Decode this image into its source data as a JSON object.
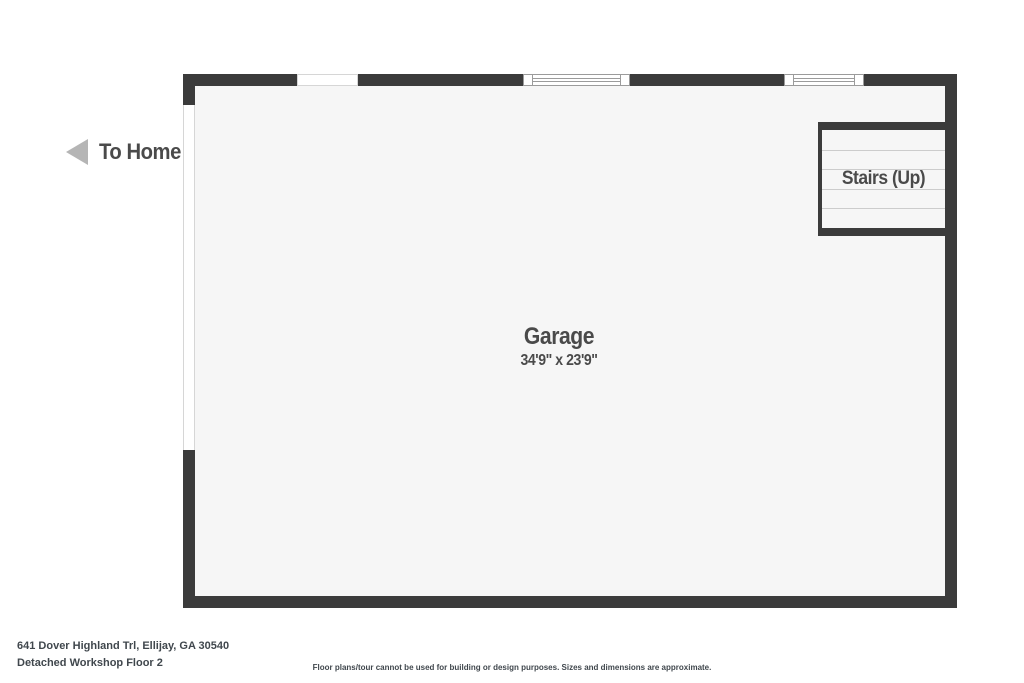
{
  "nav": {
    "to_home_label": "To Home"
  },
  "rooms": {
    "garage": {
      "name": "Garage",
      "dimensions": "34'9\" x 23'9\""
    },
    "stairs": {
      "label": "Stairs (Up)"
    }
  },
  "footer": {
    "address": "641 Dover Highland Trl, Ellijay, GA 30540",
    "floor_label": "Detached Workshop Floor 2",
    "disclaimer": "Floor plans/tour cannot be used for building or design purposes. Sizes and dimensions are approximate."
  },
  "colors": {
    "wall": "#3b3b3b",
    "interior": "#f6f6f6",
    "tread_line": "#cccccc",
    "window_border": "#9b9b9b",
    "opening_border": "#d6d6d6",
    "label_text": "#4a4a4a",
    "footer_text": "#40474d",
    "arrow": "#b5b5b5",
    "background": "#ffffff"
  }
}
